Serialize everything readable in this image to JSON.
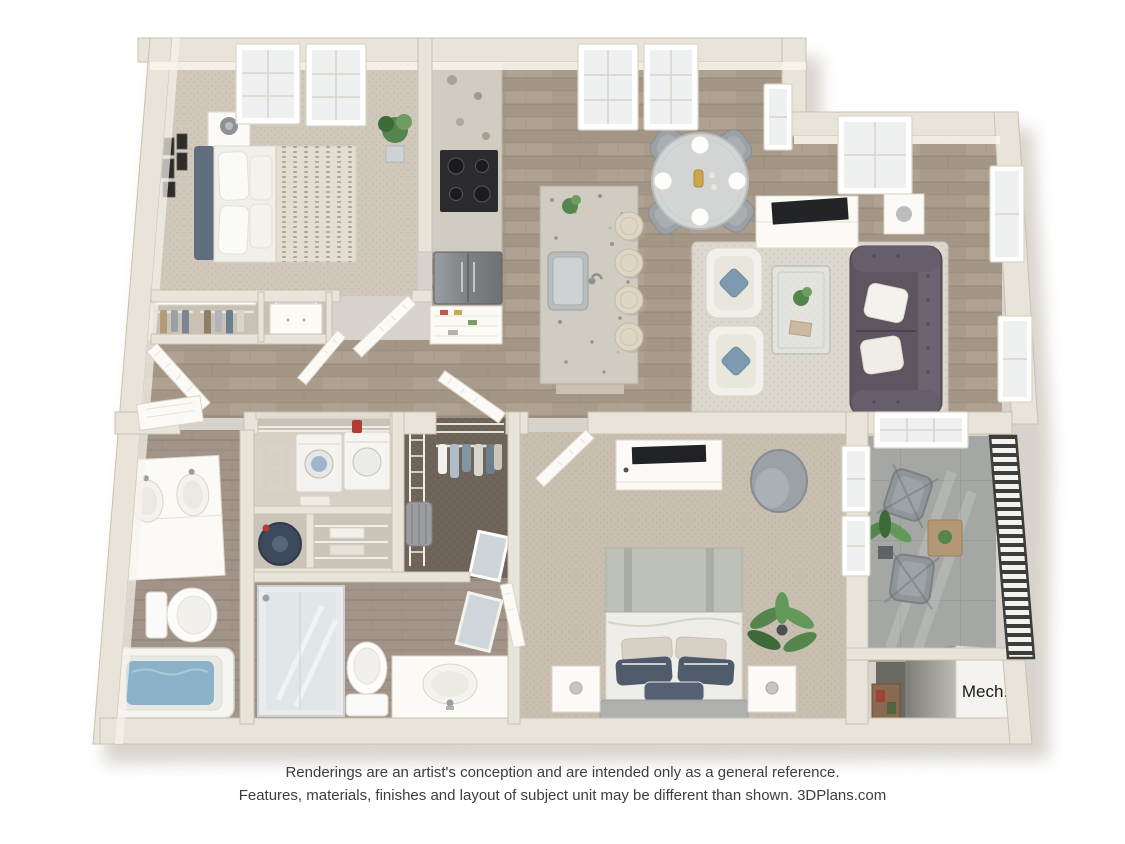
{
  "floorplan": {
    "mech_label": "Mech.",
    "rooms": [
      "bedroom-1",
      "closet-1",
      "closet-2",
      "pantry",
      "kitchen",
      "dining-area",
      "living-room",
      "hallway",
      "entry",
      "laundry-closet",
      "water-heater-closet",
      "linen-closet",
      "walk-in-closet",
      "bathroom-1",
      "bathroom-2",
      "bedroom-2",
      "balcony",
      "mechanical-room"
    ],
    "colors": {
      "wall": "#e9e4d9",
      "wall_line": "#c9c1b2",
      "wall_inner": "#f7f4ec",
      "wood": "#aa9c8b",
      "wood_line": "#968875",
      "carpet1": "#cfc8bb",
      "carpet1_dot": "#c1baac",
      "carpet2": "#c9bfb1",
      "carpet2_dot": "#bbb0a1",
      "bath_tile": "#a29488",
      "bath_line": "#8e8073",
      "closet_floor": "#6f655b",
      "closet_dot": "#5f574e",
      "balcony_floor": "#a5a7a4",
      "balcony_line": "#969894",
      "rug": "#dcd8ce",
      "rug_dot": "#cdc8bc",
      "sofa": "#5d5661",
      "sofa_dark": "#4a4450",
      "pillow_blue": "#7e9ab1",
      "navy": "#4f5a6b",
      "sage": "#bdc1b7",
      "headboard_blue": "#5f6d7d",
      "headboard_gray": "#afb1ae",
      "water": "#8cb2ca",
      "granite": "#d1ccc1",
      "stool": "#ded6c5",
      "appliance": "#2c2c2e",
      "steel": "#8d9093",
      "chair_gray": "#9ba1a5",
      "glass": "#dfe5e7",
      "plant": "#55854c",
      "plant_dark": "#3e6a39",
      "door": "#fbfaf7",
      "frame": "#dad5c9",
      "railing": "#3d3d3b",
      "mech_floor": "#6b6862",
      "crate": "#8a6a4e",
      "text": "#3d3d3d",
      "mech_text": "#1b1b1b"
    }
  },
  "disclaimer": {
    "line1": "Renderings are an artist's conception and are intended only as a general reference.",
    "line2": "Features, materials, finishes and layout of subject unit may be different than shown. 3DPlans.com"
  }
}
